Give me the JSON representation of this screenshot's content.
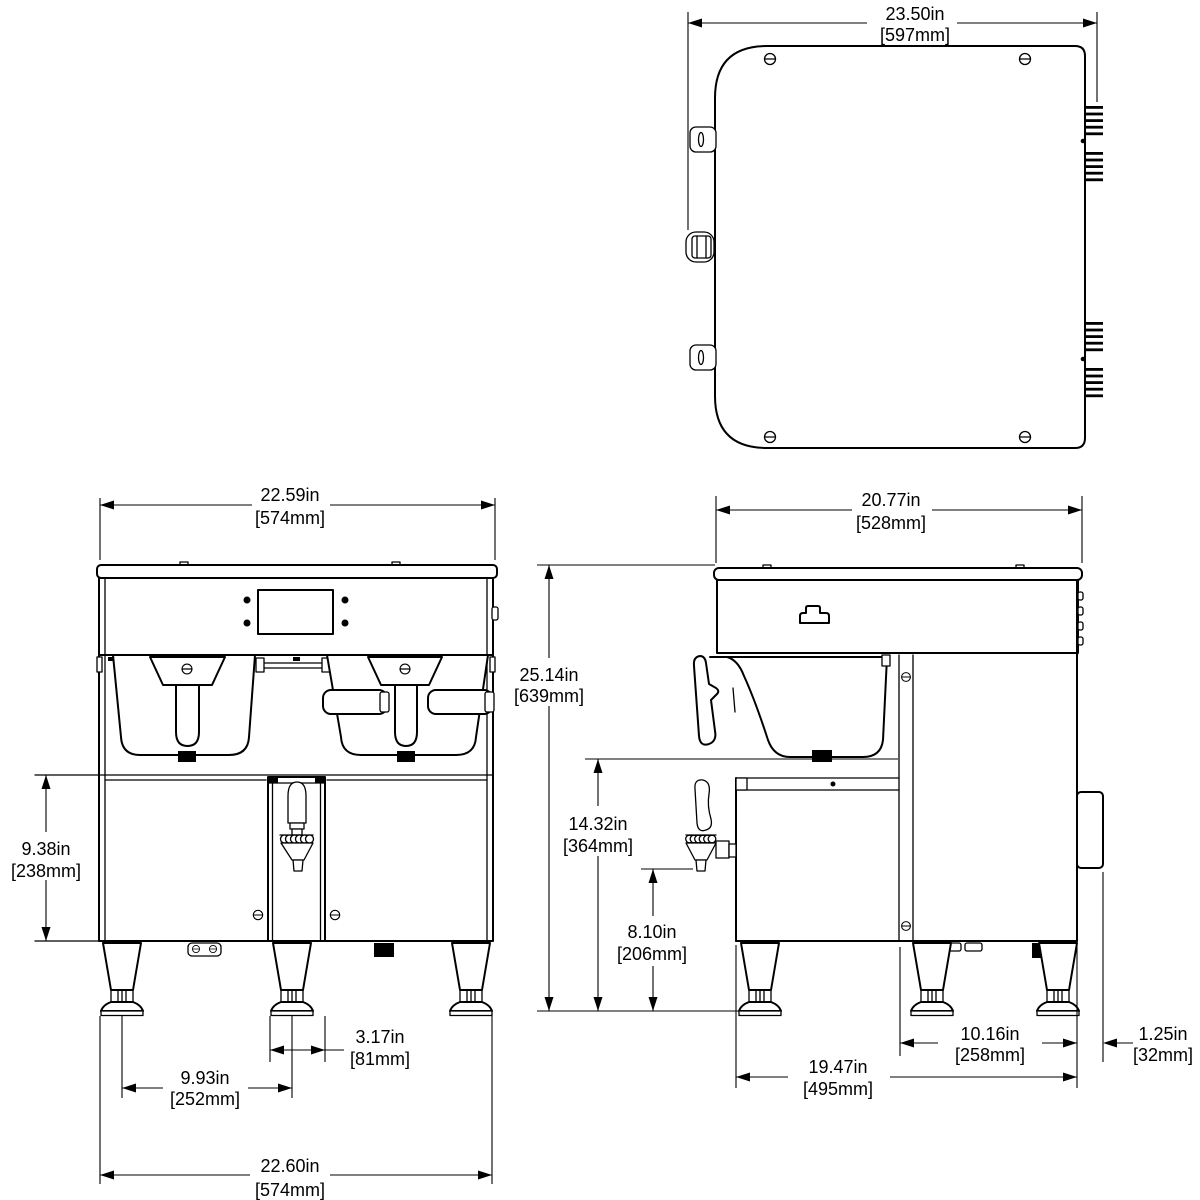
{
  "canvas": {
    "background": "#ffffff",
    "line_color": "#000000"
  },
  "dims": {
    "top_width": {
      "in": "23.50in",
      "mm": "[597mm]"
    },
    "front_top_width": {
      "in": "22.59in",
      "mm": "[574mm]"
    },
    "side_top_width": {
      "in": "20.77in",
      "mm": "[528mm]"
    },
    "overall_height": {
      "in": "25.14in",
      "mm": "[639mm]"
    },
    "front_lower_height": {
      "in": "9.38in",
      "mm": "[238mm]"
    },
    "funnel_clearance": {
      "in": "14.32in",
      "mm": "[364mm]"
    },
    "faucet_clearance": {
      "in": "8.10in",
      "mm": "[206mm]"
    },
    "faucet_tower_width": {
      "in": "3.17in",
      "mm": "[81mm]"
    },
    "leg_spacing": {
      "in": "9.93in",
      "mm": "[252mm]"
    },
    "front_bottom_width": {
      "in": "22.60in",
      "mm": "[574mm]"
    },
    "rear_leg_spacing": {
      "in": "10.16in",
      "mm": "[258mm]"
    },
    "side_depth": {
      "in": "19.47in",
      "mm": "[495mm]"
    },
    "rear_clearance": {
      "in": "1.25in",
      "mm": "[32mm]"
    }
  }
}
